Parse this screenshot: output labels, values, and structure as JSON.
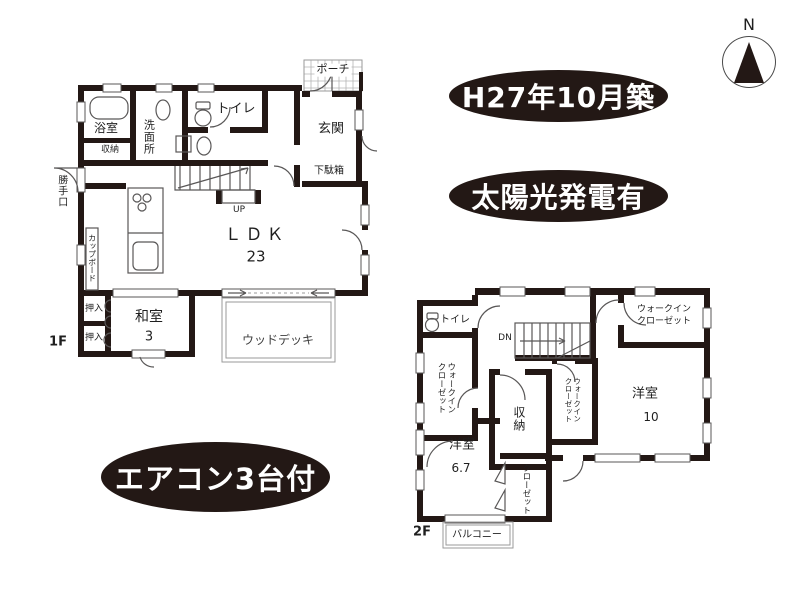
{
  "colors": {
    "wall": "#231815",
    "line": "#595757",
    "badge_bg": "#231815",
    "badge_text": "#ffffff",
    "text": "#1f1f1f"
  },
  "compass": {
    "north_label": "N"
  },
  "badges": {
    "built": "H27年10月築",
    "solar": "太陽光発電有",
    "aircon": "エアコン3台付"
  },
  "floor1": {
    "label": "1F",
    "bath": "浴室",
    "washroom": "洗面所",
    "toilet": "トイレ",
    "storage": "収納",
    "back_door": "勝手口",
    "cupboard": "カップボード",
    "porch": "ポーチ",
    "entrance": "玄関",
    "shoe_cabinet": "下駄箱",
    "stairs_up": "UP",
    "ldk": "ＬＤＫ",
    "ldk_size": "23",
    "oshiire1": "押入",
    "oshiire2": "押入",
    "japanese_room": "和室",
    "japanese_room_size": "3",
    "wood_deck": "ウッドデッキ"
  },
  "floor2": {
    "label": "2F",
    "toilet": "トイレ",
    "wic_left": "ウォークイン\nクローゼット",
    "stairs_down": "DN",
    "storage": "収納",
    "wic_middle": "ウォークイン\nクローゼット",
    "wic_top_right": "ウォークイン\nクローゼット",
    "western_room_10": "洋室",
    "western_room_10_size": "10",
    "western_room_67": "洋室",
    "western_room_67_size": "6.7",
    "closet": "クローゼット",
    "balcony": "バルコニー"
  }
}
